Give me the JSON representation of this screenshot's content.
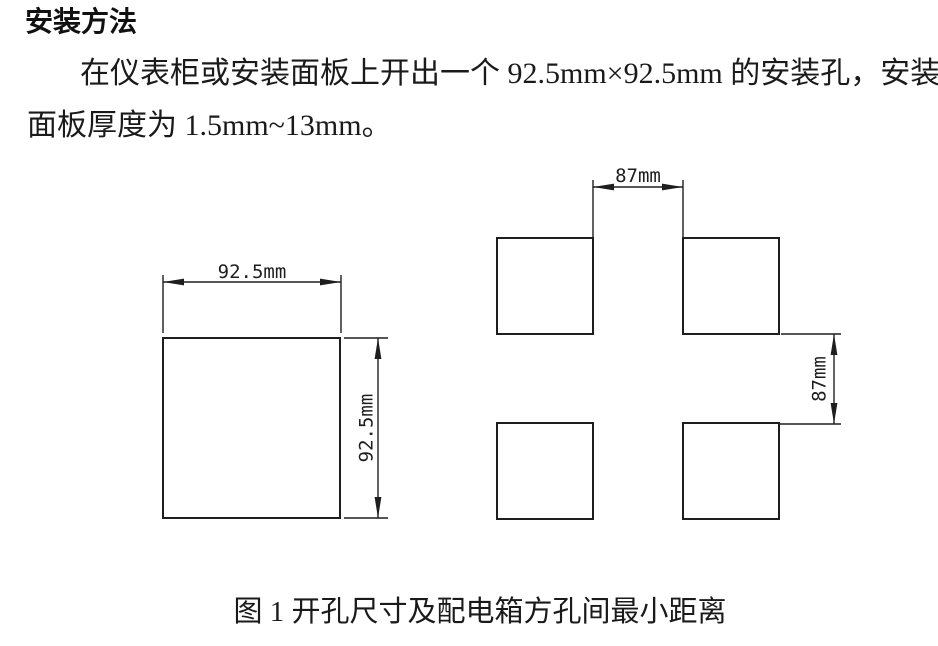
{
  "page": {
    "background": "#ffffff",
    "text_color": "#1a1a1a",
    "line_color": "#1e1e1e"
  },
  "title": "安装方法",
  "paragraph": {
    "line1": "在仪表柜或安装面板上开出一个 92.5mm×92.5mm 的安装孔，安装",
    "line2": "面板厚度为 1.5mm~13mm。"
  },
  "figure": {
    "caption": "图 1 开孔尺寸及配电箱方孔间最小距离",
    "left_panel": {
      "description": "single square cutout",
      "width_label": "92.5mm",
      "height_label": "92.5mm"
    },
    "right_panel": {
      "description": "four square holes of distribution box, minimum spacing",
      "h_gap_label": "87mm",
      "v_gap_label": "87mm"
    }
  }
}
